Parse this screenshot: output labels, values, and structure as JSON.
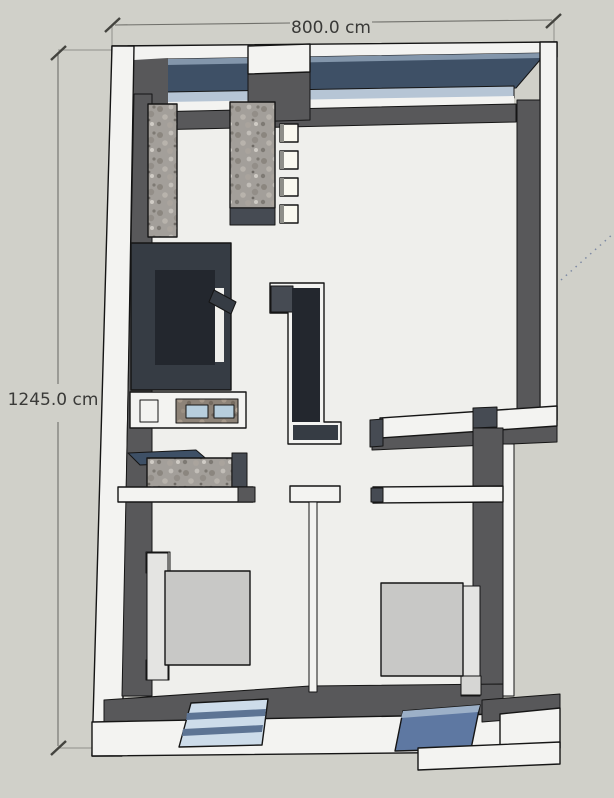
{
  "viewport": {
    "kind": "3d-floor-plan-top-view",
    "background": "#d0d0c9"
  },
  "dimensions": {
    "width_label": "800.0 cm",
    "height_label": "1245.0 cm"
  },
  "colors": {
    "background": "#d0d0c9",
    "wall_top_white": "#f3f3f1",
    "wall_inner_face": "#58585a",
    "fixture_charcoal": "#363c44",
    "top_window_glass": "#3e5066",
    "top_window_highlight": "#8396ab",
    "window_sill": "#b6c5d5",
    "bottom_window_light": "#cddcea",
    "bottom_window_dark": "#5e78a2",
    "granite_gray": "#a39f9a",
    "counter_brown": "#8d8378",
    "sink_blue": "#b7cedd",
    "mattress_gray": "#c8c8c6",
    "floor": "#efefec",
    "dimension_text": "#3a3a38",
    "guide_line": "#7d89a3"
  },
  "fixtures": {
    "top_wall": "ribbon-window",
    "kitchen": [
      "wall-counter",
      "island-counter",
      "four-small-units"
    ],
    "bathroom": [
      "shower-enclosure",
      "double-sink-vanity",
      "lower-counter"
    ],
    "bedroom_left": [
      "bed-with-headboard",
      "bottom-window-light"
    ],
    "bedroom_right": [
      "bed-with-headboard",
      "bottom-window-dark"
    ]
  }
}
